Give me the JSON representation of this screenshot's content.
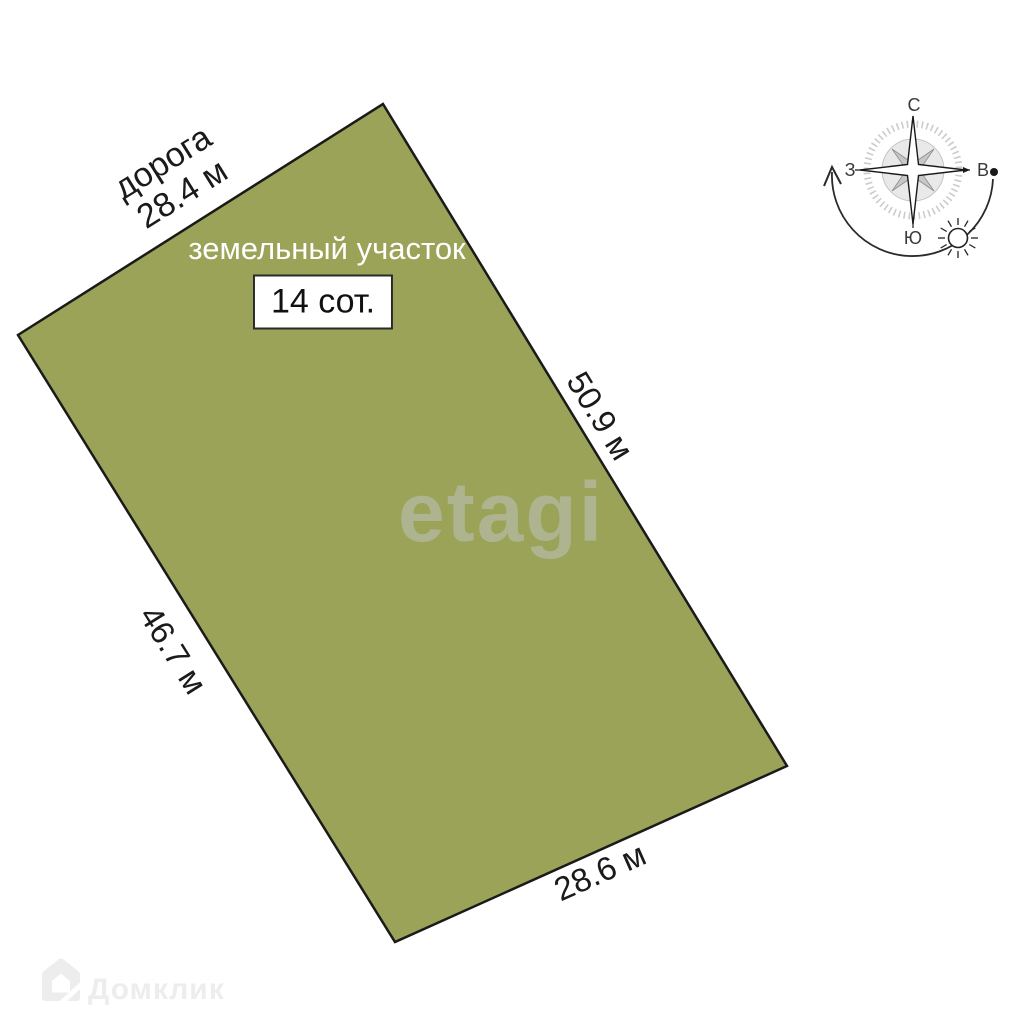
{
  "plot": {
    "name_label": "земельный участок",
    "area_badge": "14 сот.",
    "fill_color": "#9aa358",
    "border_color": "#1a1a1a",
    "sides": {
      "road_name": "дорога",
      "road_length": "28.4 м",
      "right_length": "50.9 м",
      "left_length": "46.7 м",
      "bottom_length": "28.6 м"
    }
  },
  "compass": {
    "north": "С",
    "south": "Ю",
    "west": "З",
    "east": "В"
  },
  "watermarks": {
    "brand_center": "etagi",
    "brand_corner": "Домклик"
  }
}
